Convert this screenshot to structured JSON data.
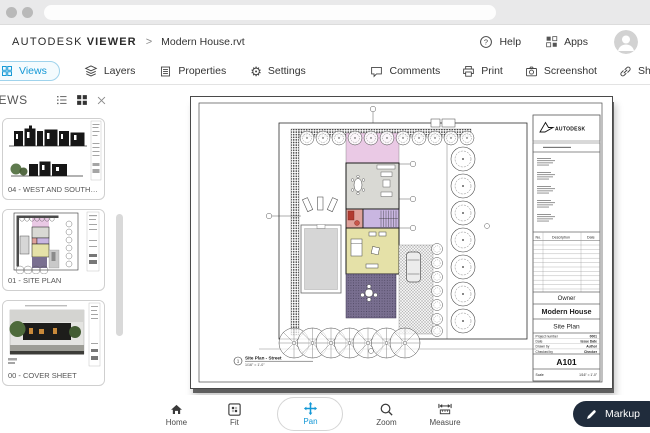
{
  "colors": {
    "accent": "#1398d6",
    "markup_bg": "#202c3c",
    "pink": "#eac9e5",
    "purple": "#c9b6e1",
    "yellow": "#e5e1a8",
    "patio": "#796f90",
    "bath": "#dfa29b",
    "room_gray": "#d9d9d4",
    "pool": "#d6d6d6",
    "tree_green": "#4e6b3b"
  },
  "header": {
    "brand": "AUTODESK",
    "product": "VIEWER",
    "separator": ">",
    "file_name": "Modern House.rvt",
    "help_label": "Help",
    "apps_label": "Apps"
  },
  "tab_bar": {
    "tabs": [
      {
        "label": "Views"
      },
      {
        "label": "Layers"
      },
      {
        "label": "Properties"
      },
      {
        "label": "Settings"
      }
    ],
    "actions": [
      {
        "label": "Comments"
      },
      {
        "label": "Print"
      },
      {
        "label": "Screenshot"
      },
      {
        "label": "Share"
      }
    ]
  },
  "views_panel": {
    "title": "VIEWS",
    "items": [
      {
        "label": "04 - WEST AND SOUTH ELEVATIO..."
      },
      {
        "label": "01 - SITE PLAN"
      },
      {
        "label": "00 - COVER SHEET"
      }
    ]
  },
  "sheet": {
    "logo_text": "AUTODESK",
    "revision_header": {
      "no": "No.",
      "description": "Description",
      "date": "Date"
    },
    "owner": "Owner",
    "project_name": "Modern House",
    "sheet_title": "Site Plan",
    "sheet_number": "A101",
    "params": [
      {
        "label": "Project number",
        "value": "0001"
      },
      {
        "label": "Date",
        "value": "Issue Date"
      },
      {
        "label": "Drawn by",
        "value": "Author"
      },
      {
        "label": "Checked by",
        "value": "Checker"
      }
    ],
    "scale_label": "Scale",
    "scale_value": "1/16\" = 1'-0\"",
    "view_number": "1",
    "view_title": "Site Plan - Street",
    "view_scale": "1/16\" = 1'-0\""
  },
  "bottom_toolbar": {
    "tools": [
      {
        "label": "Home"
      },
      {
        "label": "Fit"
      },
      {
        "label": "Pan"
      },
      {
        "label": "Zoom"
      },
      {
        "label": "Measure"
      }
    ],
    "active_tool": "Pan",
    "markup_label": "Markup"
  }
}
